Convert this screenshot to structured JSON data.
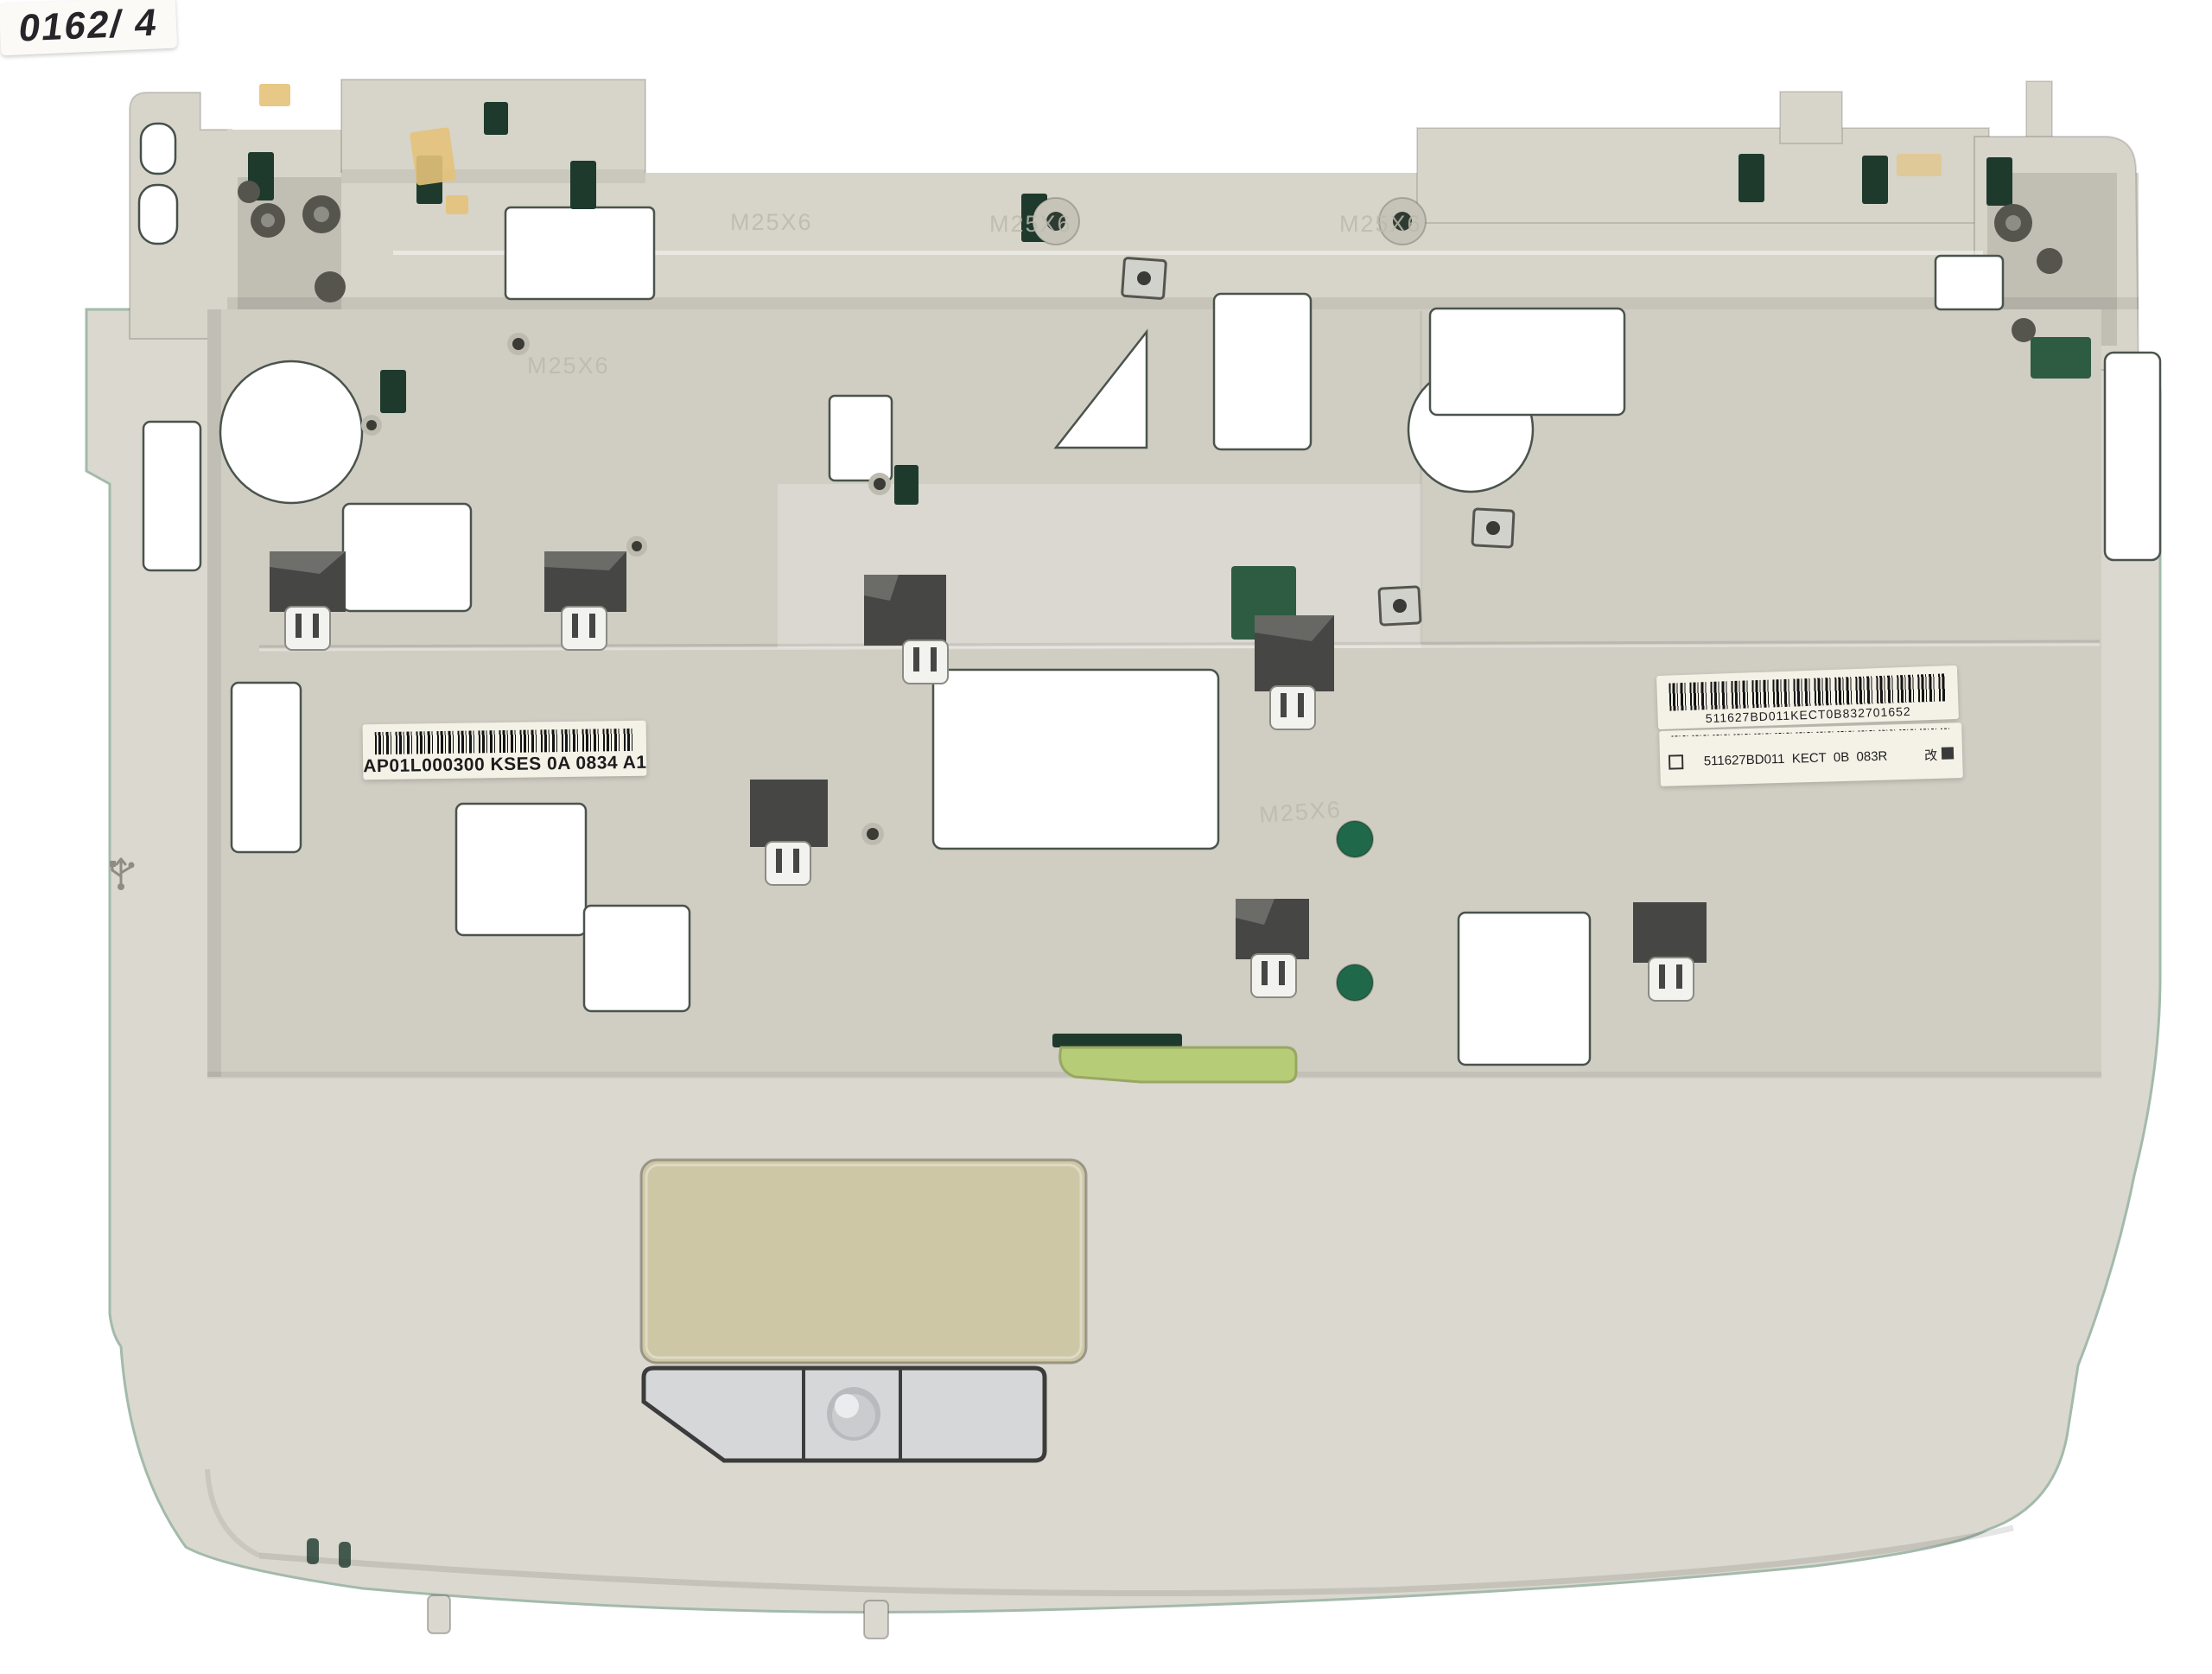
{
  "scene": {
    "description": "Photograph of a beige laptop palmrest / top-case assembly viewed from above on a plain white background, with keyboard-tray cutouts, EMI foil patches, barcode stickers, a khaki touchpad and a silver three-part button bar",
    "background": "#ffffff"
  },
  "labels": {
    "left_barcode": "AP01L000300 KSES 0A 0834 A1",
    "right_barcode_top": "511627BD011KECT0B832701652",
    "right_barcode_bottom": "511627BD011  KECT  0B  083R",
    "right_barcode_stamp": "改",
    "handwritten_note": "0162/ 4",
    "embossed_screw_mark": "M25X6"
  },
  "icons": {
    "usb_marking": "usb-trident"
  },
  "colors": {
    "background": "#ffffff",
    "body": "#dbd8cf",
    "tray": "#d0cdc3",
    "strip": "#d7d4c9",
    "slot": "#1e3a2d",
    "slot-bright": "#2e5c42",
    "foil": "#464644",
    "foil-light": "#90908c",
    "touchpad": "#cdc7a6",
    "btn": "#d6d7d9",
    "btn-edge": "#3c3c3c",
    "green-strip": "#b6cc77",
    "green-dot": "#20684a",
    "label-bg": "#f4f2e7",
    "ink": "#1d1d1f",
    "edge": "#a3baab",
    "tape": "#e5c27a",
    "metal": "#d2d2cd",
    "emboss": "#bcbaac"
  }
}
